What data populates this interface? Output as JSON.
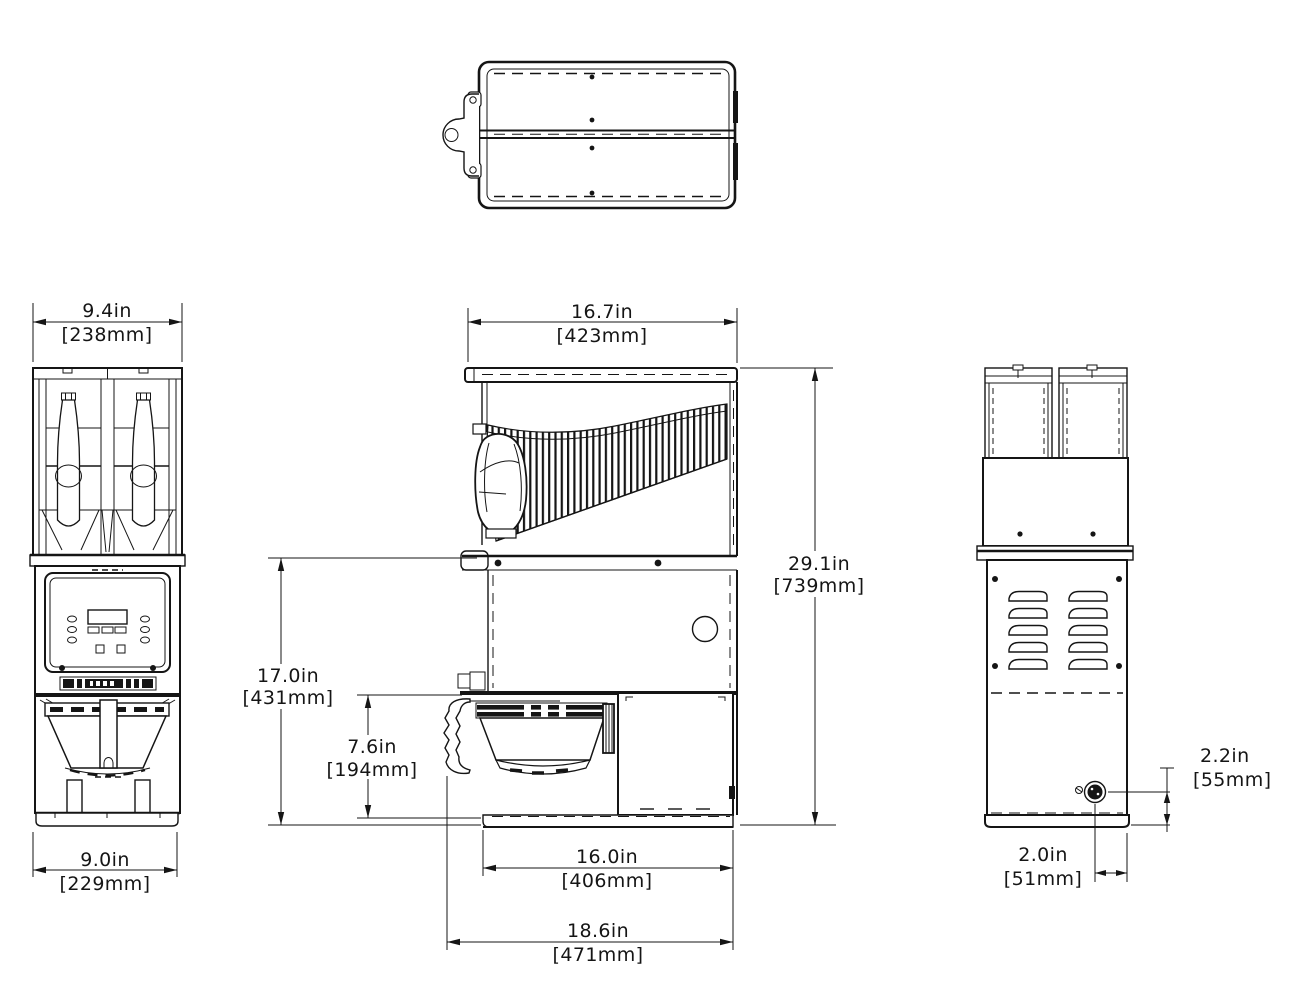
{
  "drawing": {
    "type": "dimension-drawing",
    "subject": "dual-hopper coffee grinder, four orthographic views"
  },
  "colors": {
    "line": "#151515",
    "background": "#ffffff"
  },
  "dims": {
    "hopper_width": {
      "in": "9.4in",
      "mm": "[238mm]"
    },
    "base_width": {
      "in": "9.0in",
      "mm": "[229mm]"
    },
    "top_depth": {
      "in": "16.7in",
      "mm": "[423mm]"
    },
    "overall_height": {
      "in": "29.1in",
      "mm": "[739mm]"
    },
    "counter_height": {
      "in": "17.0in",
      "mm": "[431mm]"
    },
    "funnel_clearance": {
      "in": "7.6in",
      "mm": "[194mm]"
    },
    "base_depth": {
      "in": "16.0in",
      "mm": "[406mm]"
    },
    "overall_depth": {
      "in": "18.6in",
      "mm": "[471mm]"
    },
    "cord_height": {
      "in": "2.2in",
      "mm": "[55mm]"
    },
    "cord_offset": {
      "in": "2.0in",
      "mm": "[51mm]"
    }
  }
}
